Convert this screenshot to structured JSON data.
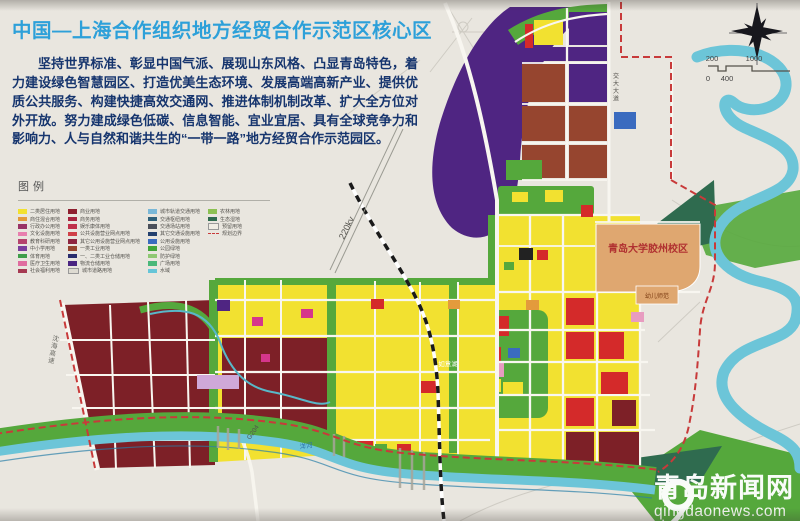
{
  "header": {
    "title": "中国—上海合作组织地方经贸合作示范区核心区",
    "paragraph": "坚持世界标准、彰显中国气派、展现山东风格、凸显青岛特色，着力建设绿色智慧园区、打造优美生态环境、发展高端高新产业、提供优质公共服务、构建快捷高效交通网、推进体制机制改革、扩大全方位对外开放。努力建成绿色低碳、信息智能、宜业宜居、具有全球竞争力和影响力、人与自然和谐共生的“一带一路”地方经贸合作示范园区。"
  },
  "legend": {
    "title": "图例",
    "columns": [
      {
        "items": [
          {
            "label": "二类居住用地",
            "color": "#f2e130"
          },
          {
            "label": "商住混合用地",
            "color": "#e39b3c"
          },
          {
            "label": "行政办公用地",
            "color": "#993366"
          },
          {
            "label": "文化设施用地",
            "color": "#e87fae"
          },
          {
            "label": "教育科研用地",
            "color": "#b5446e"
          },
          {
            "label": "中小学用地",
            "color": "#7b3f9e"
          },
          {
            "label": "体育用地",
            "color": "#3f9e4a"
          },
          {
            "label": "医疗卫生用地",
            "color": "#e06c9f"
          },
          {
            "label": "社会福利用地",
            "color": "#a63a52"
          }
        ]
      },
      {
        "items": [
          {
            "label": "商业用地",
            "color": "#8e1f2f"
          },
          {
            "label": "商务用地",
            "color": "#a8243f"
          },
          {
            "label": "娱乐康体用地",
            "color": "#c0304a"
          },
          {
            "label": "公共设施营业网点用地",
            "color": "#d04048"
          },
          {
            "label": "其它公用设施营业网点用地",
            "color": "#8e2540"
          },
          {
            "label": "一类工业用地",
            "color": "#96452f"
          },
          {
            "label": "一、二类工业仓储用地",
            "color": "#2a2d6e"
          },
          {
            "label": "物流仓储用地",
            "color": "#4a2582"
          },
          {
            "label": "城市道路用地",
            "color": "#dedbd2",
            "border": true
          }
        ]
      },
      {
        "items": [
          {
            "label": "城市轨道交通用地",
            "color": "#7ab8d8"
          },
          {
            "label": "交通枢纽用地",
            "color": "#2f607a"
          },
          {
            "label": "交通场站用地",
            "color": "#4a4f5a"
          },
          {
            "label": "其它交通设施用地",
            "color": "#23406e"
          },
          {
            "label": "公用设施用地",
            "color": "#3a6bbf"
          },
          {
            "label": "公园绿地",
            "color": "#42a53a"
          },
          {
            "label": "防护绿地",
            "color": "#8fc873"
          },
          {
            "label": "广场用地",
            "color": "#4ab87a"
          },
          {
            "label": "水域",
            "color": "#66c5d8"
          }
        ]
      },
      {
        "items": [
          {
            "label": "农林用地",
            "color": "#8cc152"
          },
          {
            "label": "生态湿地",
            "color": "#2f6b4f"
          },
          {
            "label": "预留用地",
            "color": "#f0ede4",
            "border": true
          },
          {
            "label": "规划边界",
            "color": "#c83a3a",
            "type": "dash"
          }
        ]
      }
    ]
  },
  "scale_bar": {
    "d0": "0",
    "d200": "200",
    "d400": "400",
    "d1000": "1000"
  },
  "map_labels": {
    "campus": "青岛大学胶州校区",
    "kindergarten": "幼儿师范",
    "lake": "如意湖",
    "power_line": "220kv",
    "expressway_west": "沈海高速",
    "road_g204": "G204",
    "avenue_east": "交大大道",
    "river_south": "洋河"
  },
  "watermark": {
    "site_name": "青岛新闻网",
    "site_url": "qingdaonews.com"
  },
  "colors": {
    "title": "#2da0d9",
    "para": "#16356e",
    "paper": "#e9e6df",
    "purple": "#4f2582",
    "maroon": "#7d2027",
    "red": "#d42a2a",
    "yellow": "#f2e130",
    "green": "#55a83c",
    "darkgreen": "#2f6b4f",
    "river": "#6cc5d8",
    "lake": "#74c6da",
    "orange": "#dfa770",
    "magenta": "#d6368b",
    "pink": "#e89cc0",
    "lavender": "#cfa8d8",
    "blue": "#3a6bbf",
    "brown": "#96452f",
    "road": "#f8f6f0",
    "boundary": "#c83a3a"
  }
}
